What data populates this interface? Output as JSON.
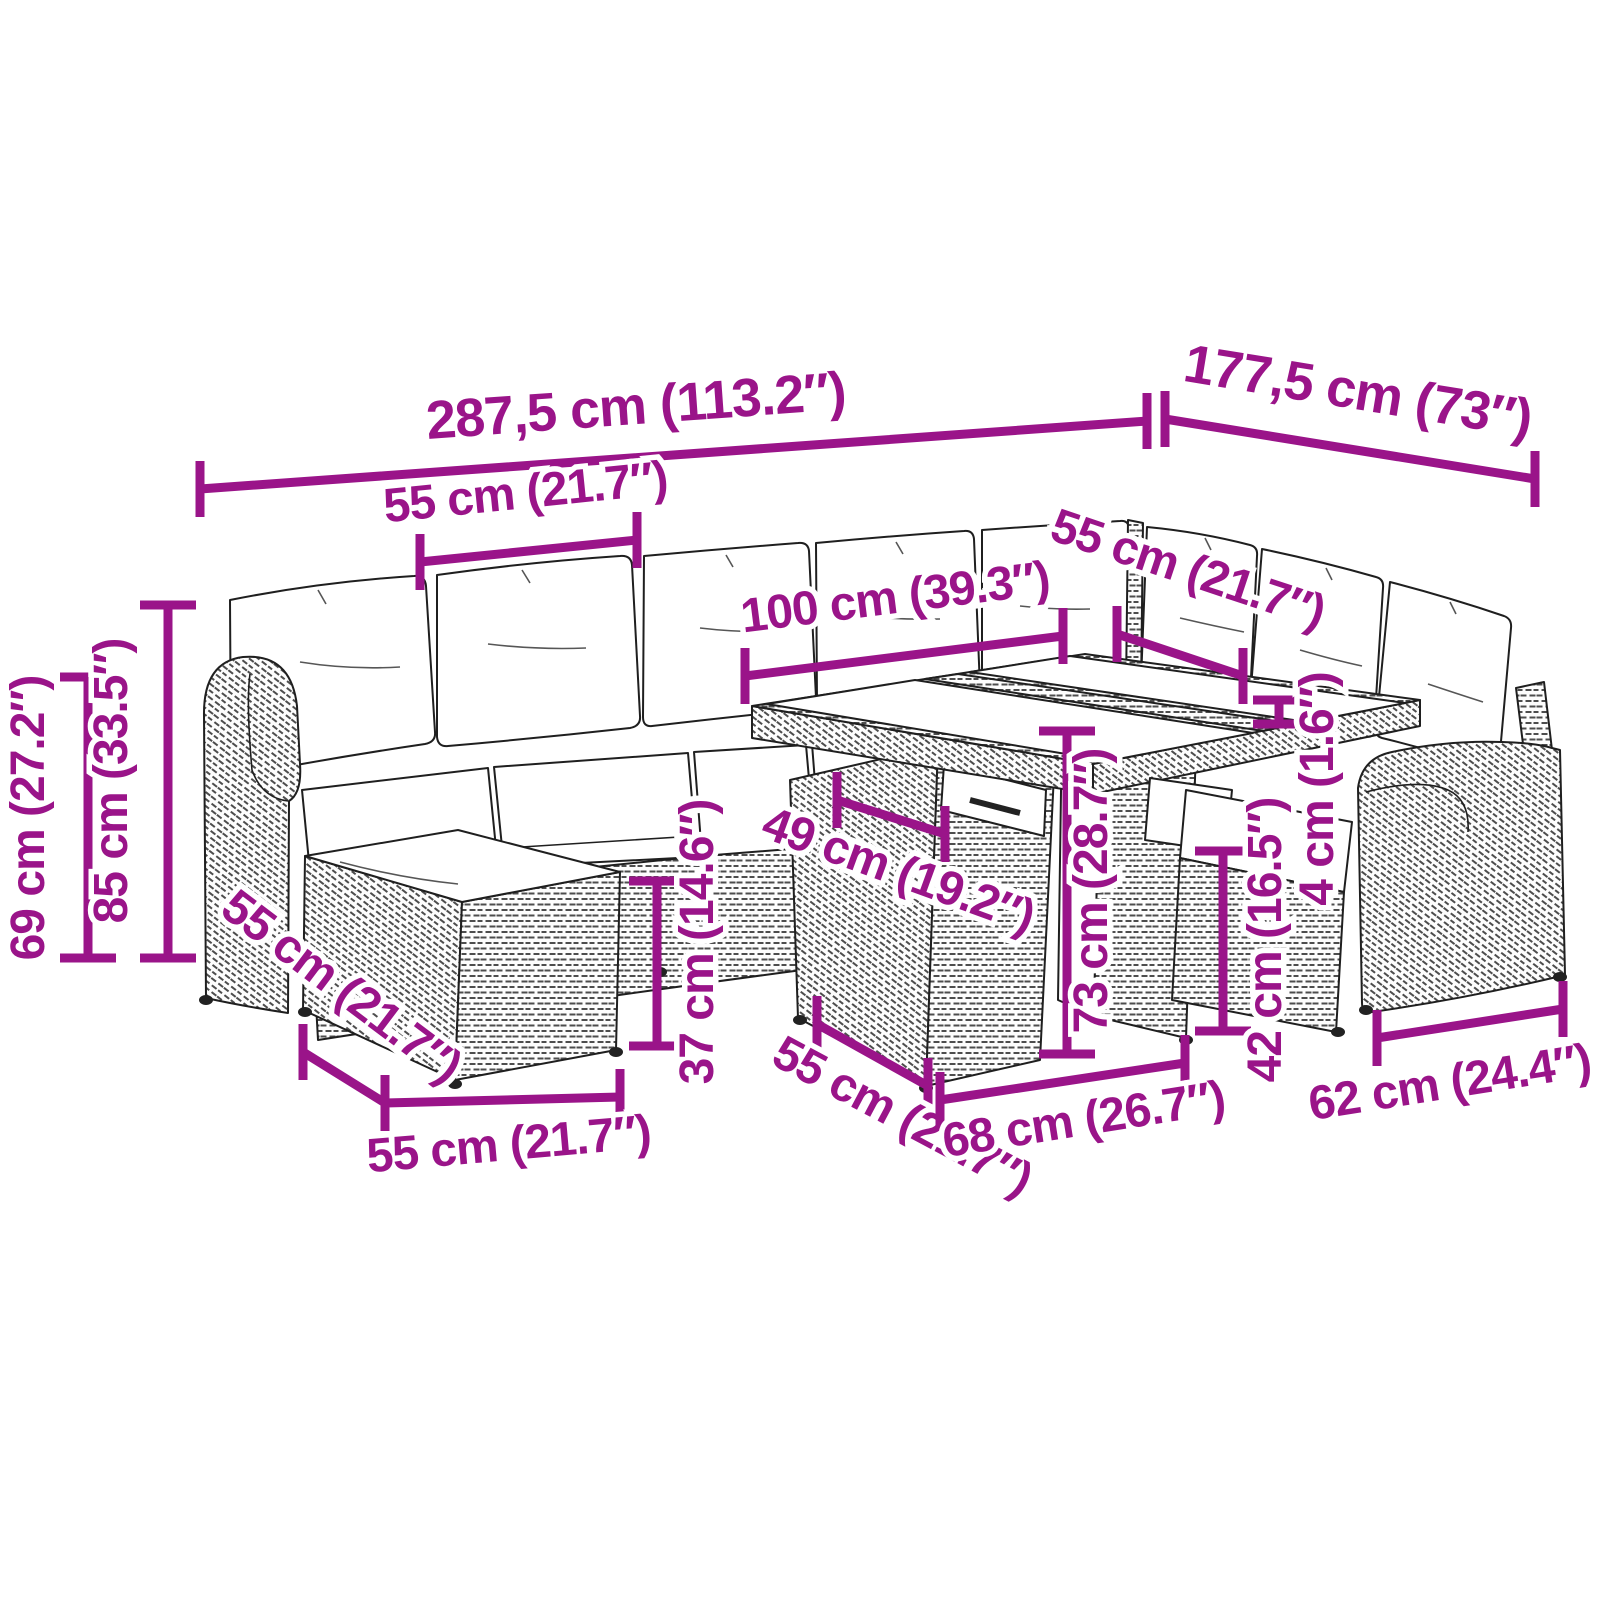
{
  "diagram": {
    "type": "product-dimension-diagram",
    "subject": "modular poly-rattan garden lounge set: corner sofa with cushions, ottomans and two-panel glass-top table",
    "background_color": "#ffffff",
    "artwork_color": "#1f1f1f",
    "dimension_color": "#9A1489"
  },
  "dimensions": {
    "overall_width": "287,5 cm (113.2″)",
    "overall_depth": "177,5 cm (73″)",
    "back_seat_width": "55 cm (21.7″)",
    "table_top_length": "100 cm (39.3″)",
    "right_seat_width": "55 cm (21.7″)",
    "table_top_thickness": "4 cm (1.6″)",
    "armrest_height": "69 cm (27.2″)",
    "total_height": "85 cm (33.5″)",
    "seat_height": "37 cm (14.6″)",
    "table_top_depth": "49 cm (19.2″)",
    "table_height": "73 cm (28.7″)",
    "ottoman_height": "42 cm (16.5″)",
    "front_module_depth": "55 cm (21.7″)",
    "table_base_width": "68 cm (26.7″)",
    "right_module_width": "62 cm (24.4″)",
    "ottoman_left_depth": "55 cm (21.7″)",
    "ottoman_left_width": "55 cm (21.7″)"
  }
}
